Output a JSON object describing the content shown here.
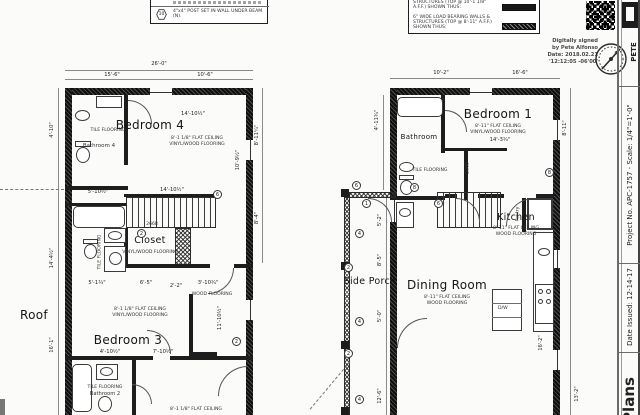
{
  "sheet": {
    "notes_box": {
      "symbol": "10",
      "post_note": "4\"x4\" POST SET IN WALL UNDER BEAM (N)."
    },
    "legend": {
      "row1": "STRUCTURES (TOP @ 10'-1 1/8\" A.F.F.) SHOWN THUS:",
      "row2": "6\" WIDE LOAD BEARING WALLS & STRUCTURES (TOP @ 8'-11\" A.F.F.) SHOWN THUS:"
    },
    "signature": {
      "l1": "Digitally signed",
      "l2": "by Pete Alfonso",
      "l3": "Date: 2018.02.21",
      "l4": "'12:12:05 -06'00'"
    },
    "titleblock": {
      "project": "Project No. APC-1757 - Scale: 1/4\"=1'-0\"",
      "date": "Date Issued: 12-14-17",
      "sheet_name": "Plans",
      "firm": "PETE"
    }
  },
  "plan_left": {
    "rooms": {
      "bedroom4": {
        "name": "Bedroom 4",
        "ceiling": "8'-1 1/8\" FLAT CEILING",
        "floor": "VINYL/WOOD FLOORING"
      },
      "bathroom4": {
        "name": "Bathroom 4",
        "floor": "TILE FLOORING"
      },
      "bathroom3": {
        "floor": "TILE FLOORING"
      },
      "closet": {
        "name": "Closet",
        "floor": "VINYL/WOOD FLOORING"
      },
      "bedroom3": {
        "name": "Bedroom 3",
        "ceiling": "8'-1 1/8\" FLAT CEILING",
        "floor": "VINYL/WOOD FLOORING"
      },
      "bathroom2": {
        "name": "Bathroom 2",
        "floor": "TILE FLOORING"
      },
      "hall_floor": "WOOD FLOORING",
      "partial_ceiling": "8'-1 1/8\" FLAT CEILING",
      "roof": "Roof"
    },
    "dims": {
      "total": "26'-0\"",
      "top_left": "15'-6\"",
      "top_right": "10'-6\"",
      "bed4_w": "14'-10½\"",
      "bed4_h": "10'-9½\"",
      "right_upper": "8'-11¼\"",
      "right_mid": "8'-4\"",
      "left_upper": "4'-10\"",
      "left_mid": "14'-4½\"",
      "left_lower": "16'-1\"",
      "stair_w": "14'-10½\"",
      "bath_w": "5'-10½\"",
      "closet_a": "5'-1¾\"",
      "closet_b": "6'-5\"",
      "closet_c": "2'-2\"",
      "closet_d": "3'-10¾\"",
      "bed3_a": "4'-10½\"",
      "bed3_b": "7'-10½\"",
      "bed3_h": "11'-10½\""
    },
    "door_tag": "2668"
  },
  "plan_right": {
    "rooms": {
      "bedroom1": {
        "name": "Bedroom 1",
        "ceiling": "8'-11\" FLAT CEILING",
        "floor": "VINYL/WOOD FLOORING"
      },
      "bathroom": {
        "name": "Bathroom",
        "floor": "TILE FLOORING"
      },
      "kitchen": {
        "name": "Kitchen",
        "ceiling": "8'-11\" FLAT CEILING",
        "floor": "WOOD FLOORING"
      },
      "dining": {
        "name": "Dining Room",
        "ceiling": "8'-11\" FLAT CEILING",
        "floor": "WOOD FLOORING"
      },
      "pantry": "Pantry",
      "porch": "Side Porch",
      "island": "D/W"
    },
    "dims": {
      "top_left": "10'-2\"",
      "top_right": "16'-6\"",
      "bed1_w": "14'-3¾\"",
      "bed1_h": "8'-11\"",
      "bath_h": "4'-11¾\"",
      "porch_a": "5'-2\"",
      "porch_b": "8'-5\"",
      "porch_c": "5'-0\"",
      "porch_d": "12'-6\"",
      "kit_h": "16'-2\"",
      "din_a": "5'-6\"",
      "din_b": "13'-2\""
    },
    "door_tag": "2668"
  },
  "callouts": {
    "n1": "1",
    "n2": "2",
    "n4": "4",
    "n6": "6",
    "n8": "8",
    "n10": "10"
  }
}
